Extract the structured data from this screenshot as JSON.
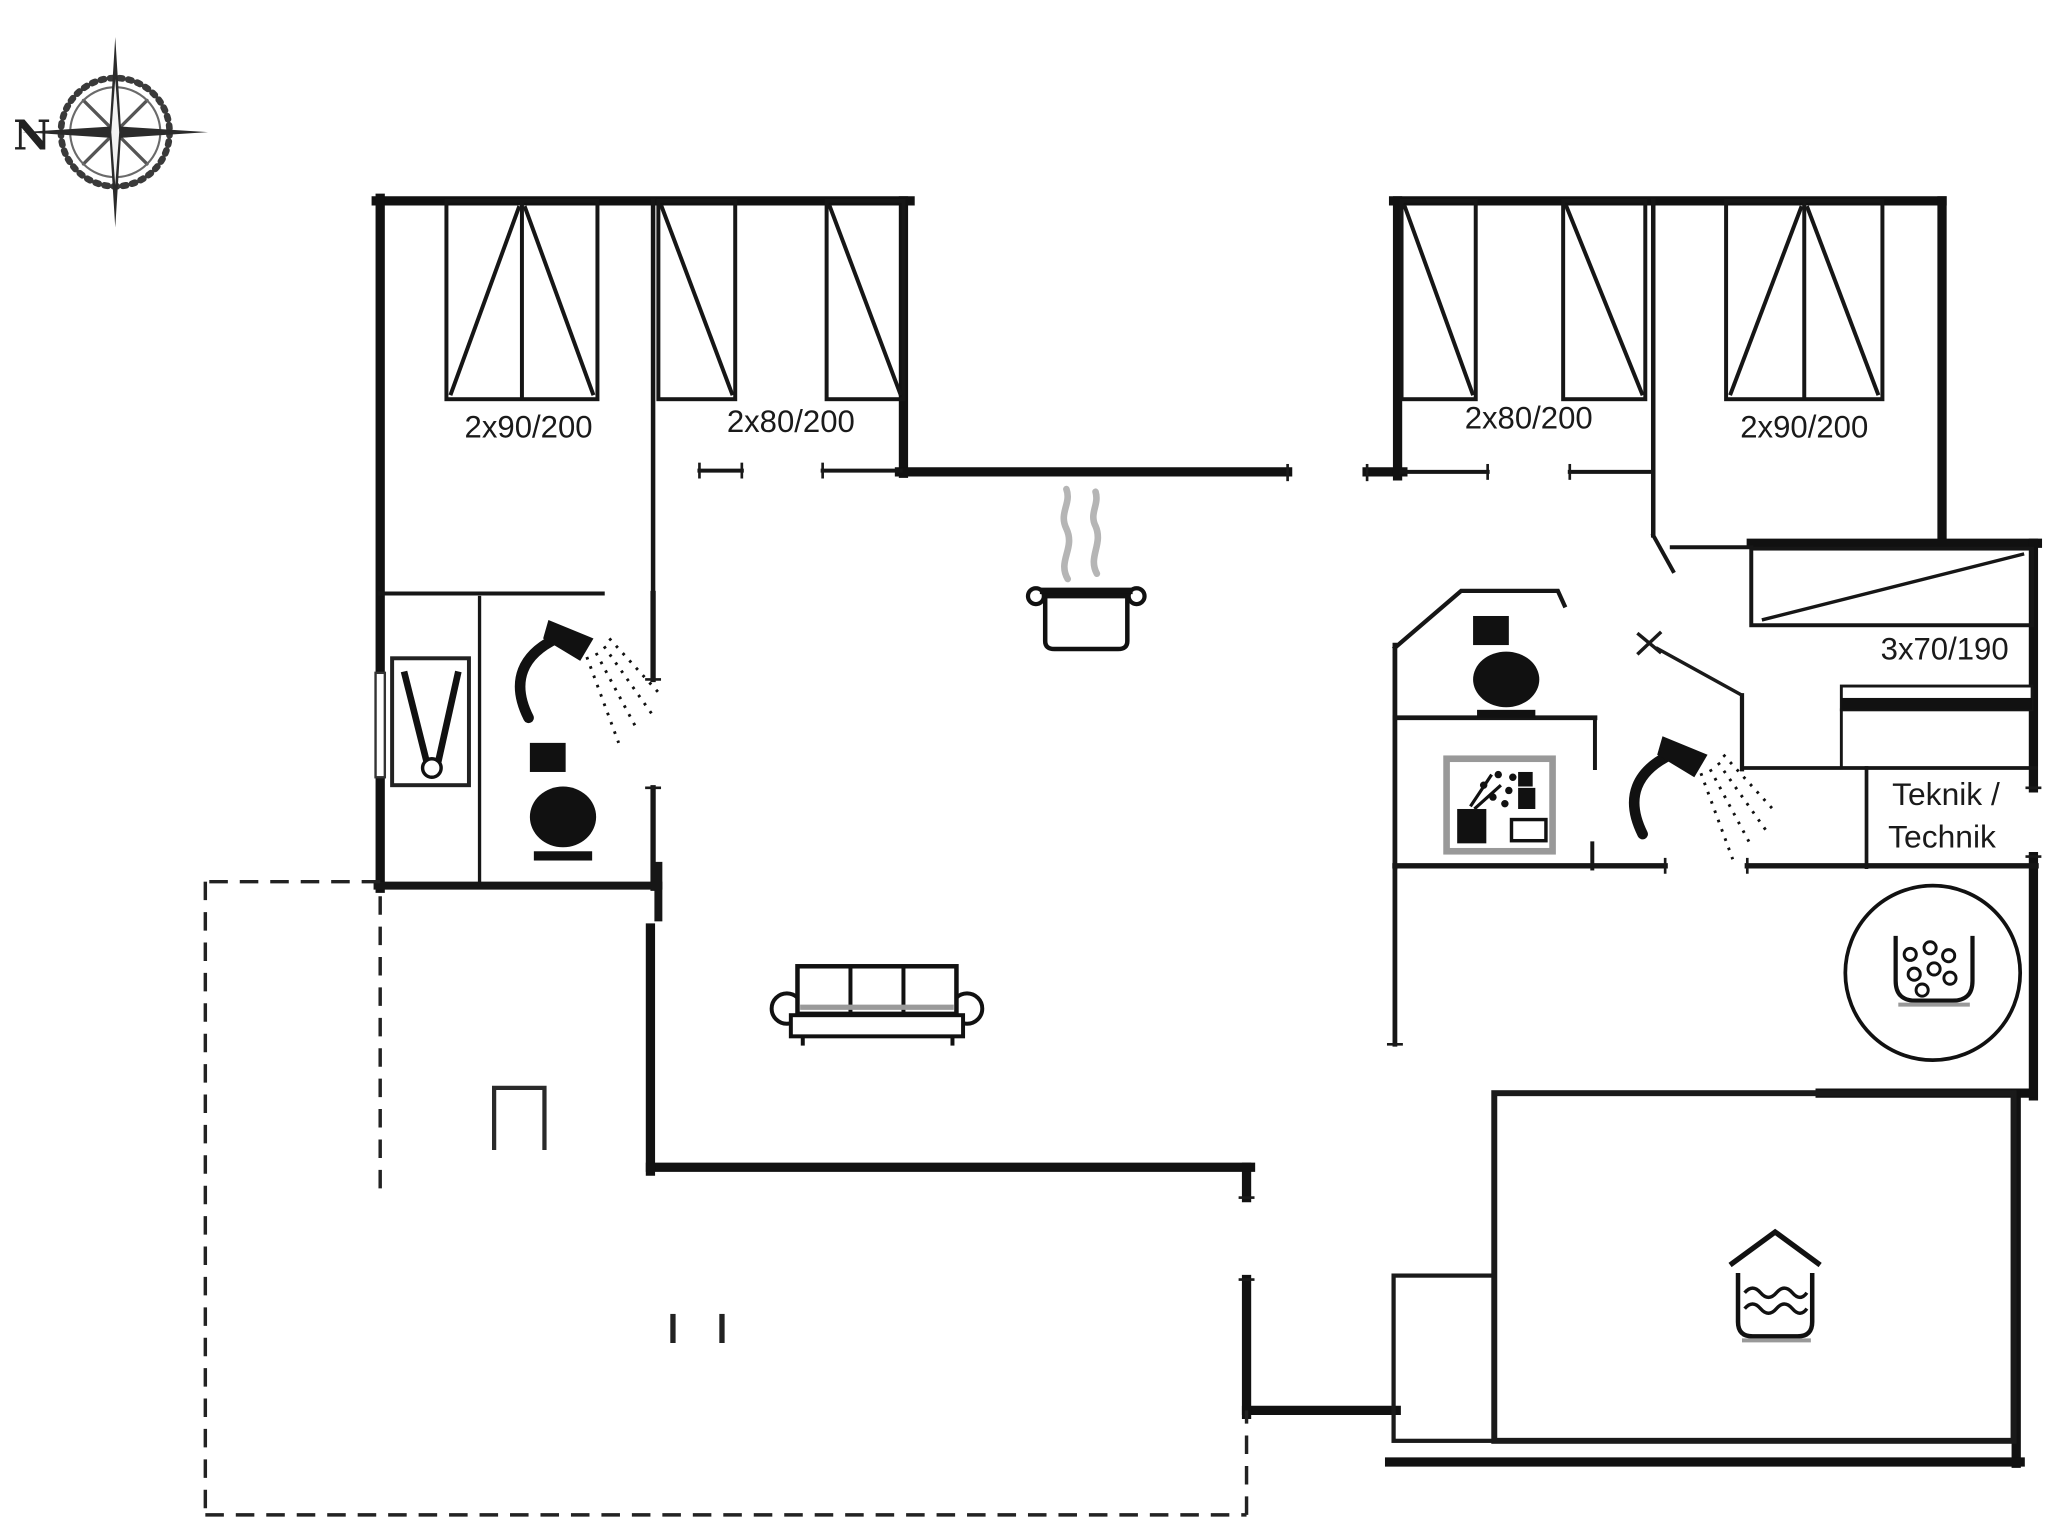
{
  "title": "Holiday home floor plan",
  "colors": {
    "line": "#1a1a1a",
    "wall": "#111111",
    "steam_gray": "#b5b5b5",
    "icon_gray": "#999999",
    "background": "#ffffff"
  },
  "compass": {
    "north_label": "N"
  },
  "beds": {
    "left_double_label": "2x90/200",
    "left_singles_label": "2x80/200",
    "right_singles_label": "2x80/200",
    "right_double_label": "2x90/200",
    "closet_bed_label": "3x70/190"
  },
  "rooms": {
    "technic_line1": "Teknik /",
    "technic_line2": "Technik"
  },
  "icons": {
    "compass_rose": "compass-rose",
    "stove_pot": "pot-with-steam",
    "shower_left": "shower-head",
    "shower_right": "shower-head",
    "toilet_left": "toilet",
    "toilet_right": "toilet",
    "washbasin": "washbasin",
    "washing_machine": "laundry-pictogram",
    "sofa": "three-seat-sofa",
    "fireplace": "fireplace",
    "whirlpool": "whirlpool-tub",
    "spa_bath": "spa-bath",
    "terrace": "dashed-terrace-outline"
  }
}
